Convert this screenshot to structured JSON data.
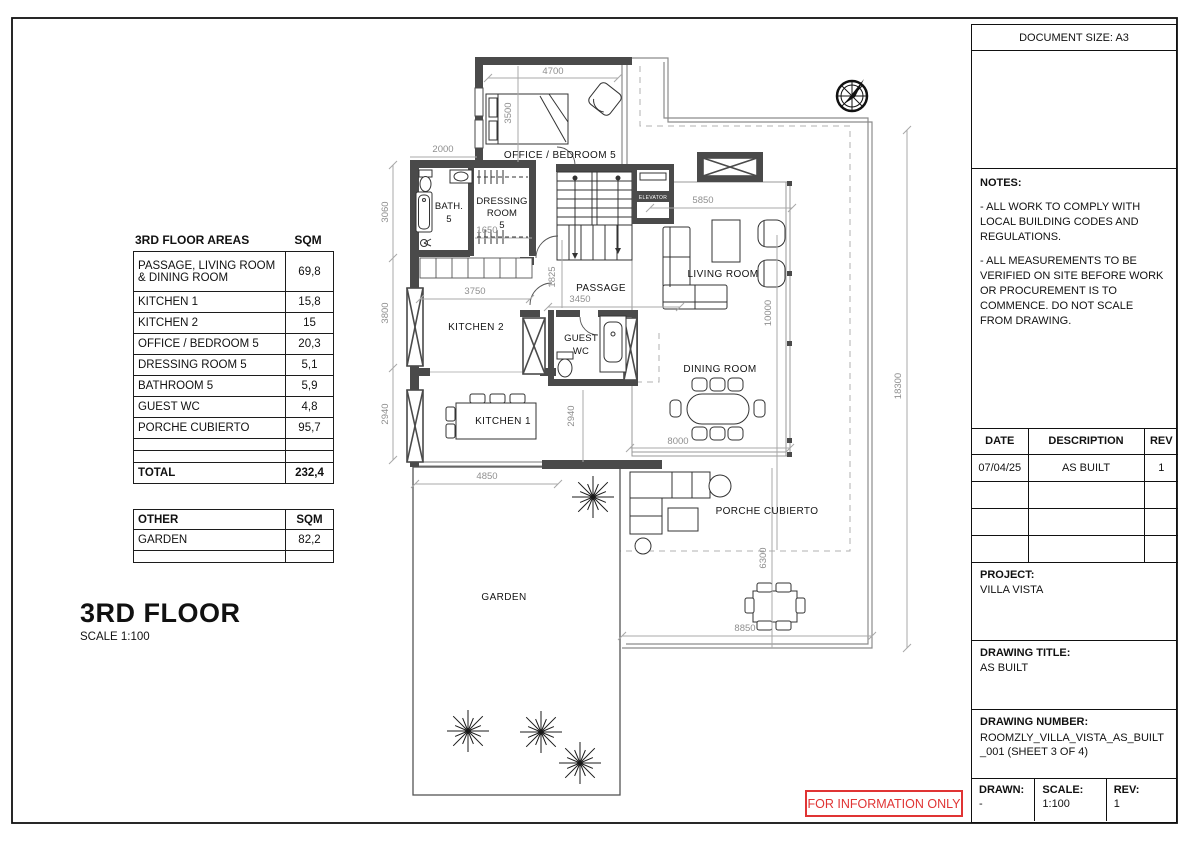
{
  "floor_title": {
    "name": "3RD FLOOR",
    "scale": "SCALE 1:100"
  },
  "areas_table": {
    "title": "3RD FLOOR AREAS",
    "unit_header": "SQM",
    "rows": [
      {
        "label": "PASSAGE, LIVING ROOM & DINING ROOM",
        "sqm": "69,8"
      },
      {
        "label": "KITCHEN 1",
        "sqm": "15,8"
      },
      {
        "label": "KITCHEN 2",
        "sqm": "15"
      },
      {
        "label": "OFFICE / BEDROOM 5",
        "sqm": "20,3"
      },
      {
        "label": "DRESSING ROOM 5",
        "sqm": "5,1"
      },
      {
        "label": "BATHROOM 5",
        "sqm": "5,9"
      },
      {
        "label": "GUEST WC",
        "sqm": "4,8"
      },
      {
        "label": "PORCHE CUBIERTO",
        "sqm": "95,7"
      },
      {
        "label": "",
        "sqm": ""
      },
      {
        "label": "",
        "sqm": ""
      }
    ],
    "total_label": "TOTAL",
    "total_value": "232,4"
  },
  "other_table": {
    "header_label": "OTHER",
    "unit_header": "SQM",
    "rows": [
      {
        "label": "GARDEN",
        "sqm": "82,2"
      },
      {
        "label": "",
        "sqm": ""
      }
    ]
  },
  "plan": {
    "labels": {
      "office": "OFFICE / BEDROOM 5",
      "bath1": "BATH.",
      "bath2": "5",
      "dressing1": "DRESSING",
      "dressing2": "ROOM",
      "dressing3": "5",
      "elevator": "ELEVATOR",
      "passage": "PASSAGE",
      "kitchen2": "KITCHEN 2",
      "guest1": "GUEST",
      "guest2": "WC",
      "living": "LIVING ROOM",
      "dining": "DINING ROOM",
      "kitchen1": "KITCHEN 1",
      "porch": "PORCHE CUBIERTO",
      "garden": "GARDEN"
    },
    "dims": {
      "d4700": "4700",
      "d3500": "3500",
      "d2000": "2000",
      "d3060": "3060",
      "d3800": "3800",
      "d2940_left": "2940",
      "d1650": "1650",
      "d3750": "3750",
      "d1825": "1825",
      "d3450": "3450",
      "d5850": "5850",
      "d10000": "10000",
      "d18300": "18300",
      "d8000": "8000",
      "d2940_mid": "2940",
      "d4850": "4850",
      "d6300": "6300",
      "d8850": "8850"
    }
  },
  "title_block": {
    "document_size": "DOCUMENT SIZE: A3",
    "notes_title": "NOTES:",
    "note1": "- ALL WORK TO COMPLY WITH LOCAL BUILDING CODES AND REGULATIONS.",
    "note2": "- ALL MEASUREMENTS TO BE VERIFIED ON SITE BEFORE WORK OR PROCUREMENT IS TO COMMENCE. DO NOT SCALE FROM DRAWING.",
    "revision_table": {
      "headers": [
        "DATE",
        "DESCRIPTION",
        "REV"
      ],
      "rows": [
        [
          "07/04/25",
          "AS BUILT",
          "1"
        ],
        [
          "",
          "",
          ""
        ],
        [
          "",
          "",
          ""
        ],
        [
          "",
          "",
          ""
        ]
      ]
    },
    "project_label": "PROJECT:",
    "project_value": "VILLA VISTA",
    "drawing_title_label": "DRAWING TITLE:",
    "drawing_title_value": "AS BUILT",
    "drawing_number_label": "DRAWING NUMBER:",
    "drawing_number_value": "ROOMZLY_VILLA_VISTA_AS_BUILT_001 (SHEET 3 OF 4)",
    "drawn_label": "DRAWN:",
    "drawn_value": "-",
    "scale_label": "SCALE:",
    "scale_value": "1:100",
    "rev_label": "REV:",
    "rev_value": "1"
  },
  "stamp": {
    "text": "FOR INFORMATION ONLY",
    "color": "#e03434"
  },
  "colors": {
    "wall": "#4a4a4a",
    "dim": "#9b9b9b",
    "stamp_red": "#e03434"
  }
}
